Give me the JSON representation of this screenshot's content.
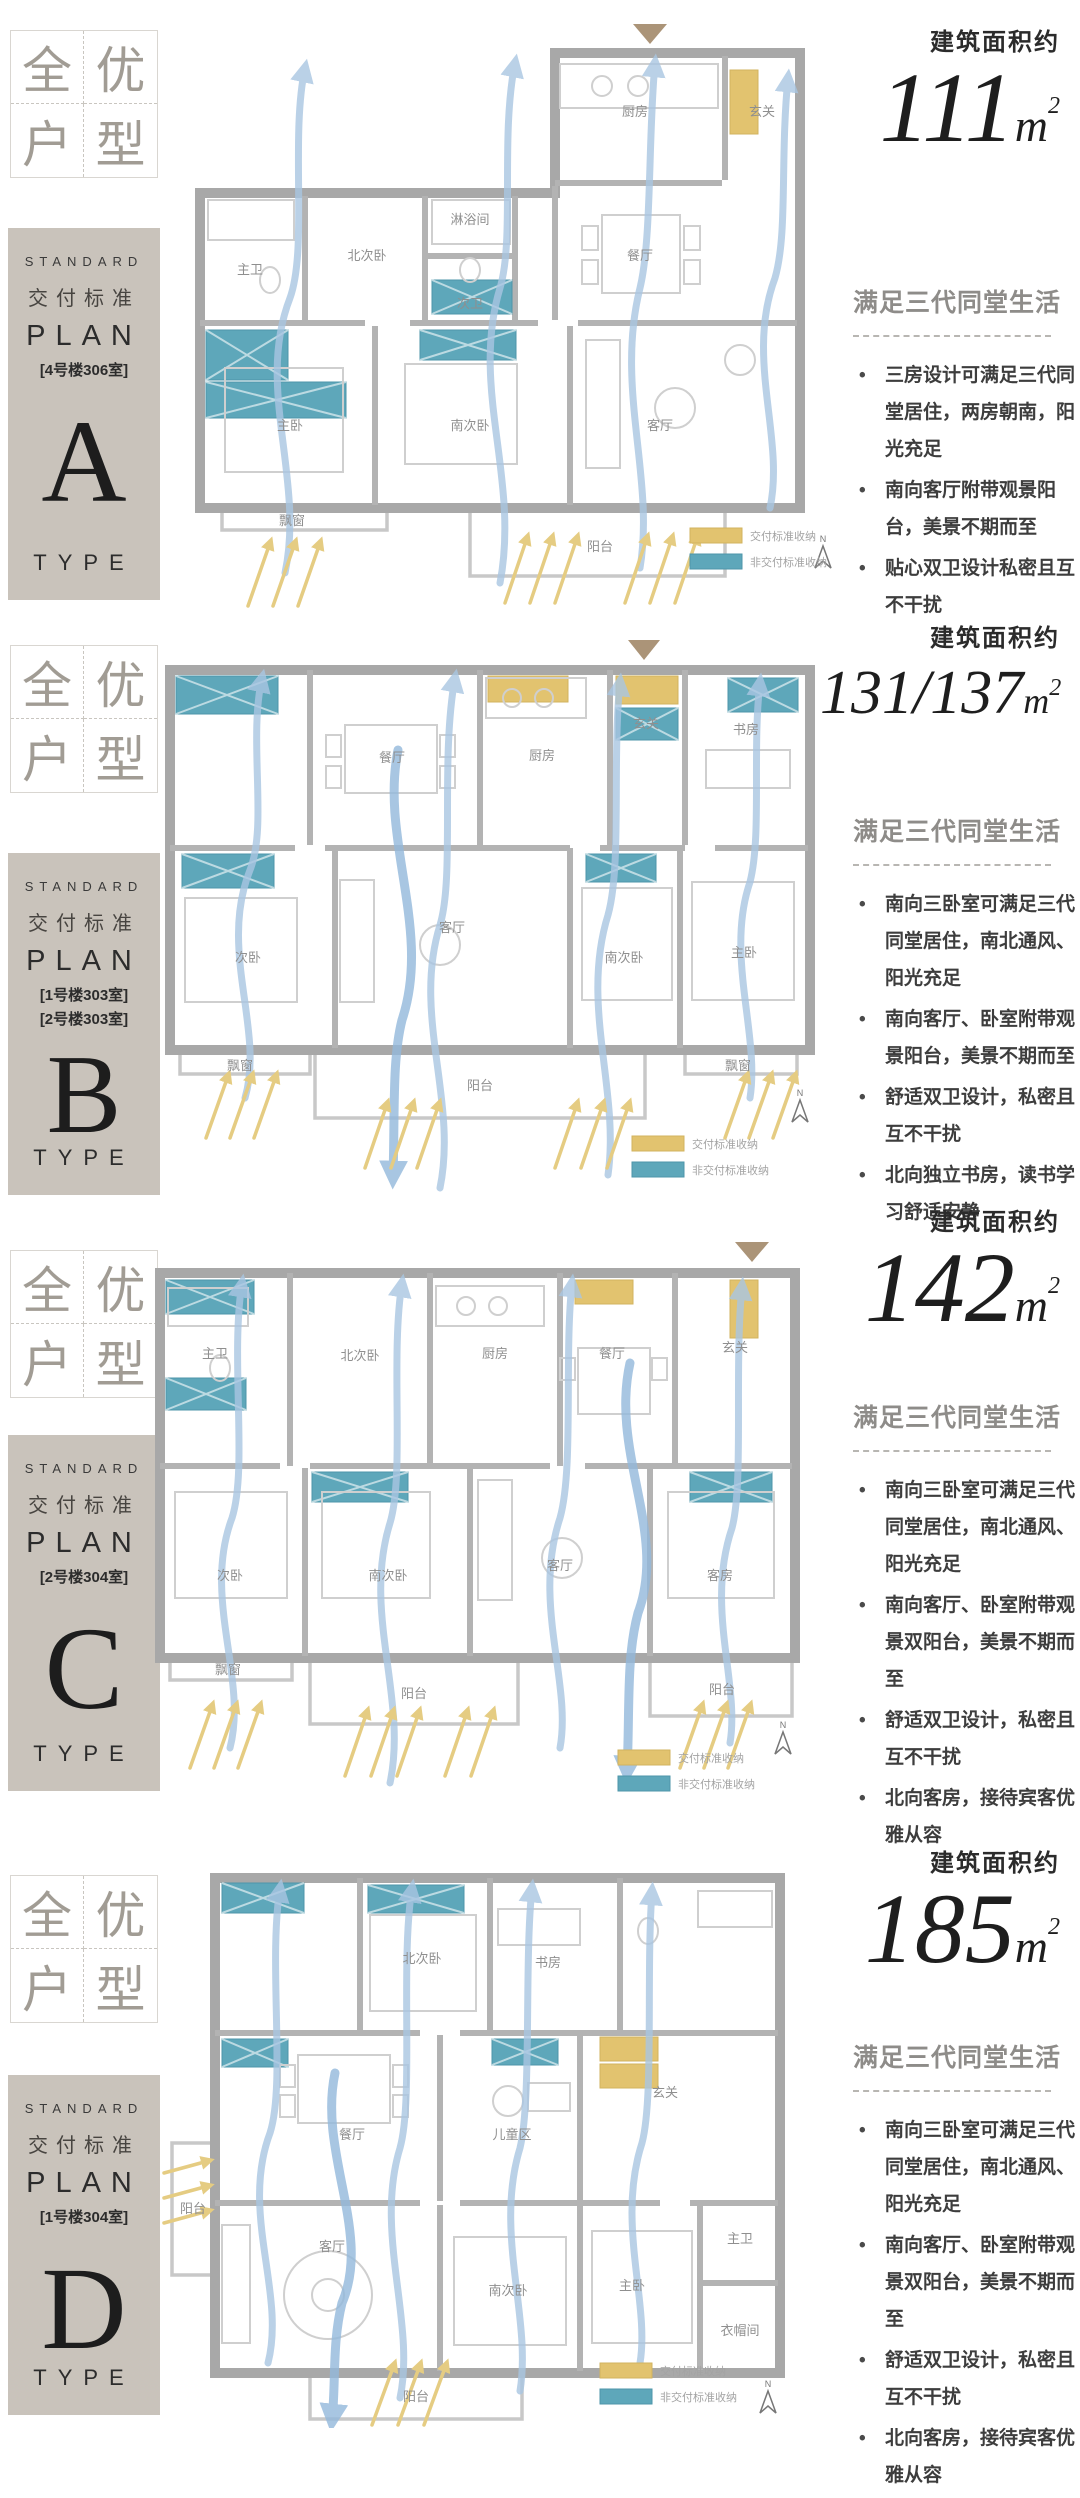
{
  "badge": {
    "c1": "全",
    "c2": "优",
    "c3": "户",
    "c4": "型"
  },
  "legend": {
    "standard": "交付标准收纳",
    "nonstandard": "非交付标准收纳"
  },
  "north": "N",
  "colors": {
    "plate_bg": "#c9c3bb",
    "storage_standard": "#e2c36f",
    "storage_nonstandard": "#5ea7ba",
    "airflow": "#a9c6e2",
    "sunlight": "#e5cc82"
  },
  "sections": [
    {
      "plate": {
        "en": "STANDARD",
        "cn": "交付标准",
        "plan": "PLAN",
        "units": [
          "[4号楼306室]"
        ],
        "letter": "A",
        "type": "TYPE"
      },
      "area": {
        "label": "建筑面积约",
        "value": "111",
        "unit_base": "m",
        "unit_sup": "2"
      },
      "desc": {
        "title": "满足三代同堂生活",
        "bullets": [
          "三房设计可满足三代同堂居住，两房朝南，阳光充足",
          "南向客厅附带观景阳台，美景不期而至",
          "贴心双卫设计私密且互不干扰"
        ]
      },
      "rooms": [
        "主卫",
        "北次卧",
        "淋浴间",
        "次卫",
        "厨房",
        "玄关",
        "餐厅",
        "主卧",
        "南次卧",
        "客厅",
        "阳台",
        "飘窗"
      ]
    },
    {
      "plate": {
        "en": "STANDARD",
        "cn": "交付标准",
        "plan": "PLAN",
        "units": [
          "[1号楼303室]",
          "[2号楼303室]"
        ],
        "letter": "B",
        "type": "TYPE"
      },
      "area": {
        "label": "建筑面积约",
        "value": "131/137",
        "unit_base": "m",
        "unit_sup": "2"
      },
      "desc": {
        "title": "满足三代同堂生活",
        "bullets": [
          "南向三卧室可满足三代同堂居住，南北通风、阳光充足",
          "南向客厅、卧室附带观景阳台，美景不期而至",
          "舒适双卫设计，私密且互不干扰",
          "北向独立书房，读书学习舒适安静"
        ]
      },
      "rooms": [
        "餐厅",
        "厨房",
        "玄关",
        "书房",
        "次卧",
        "客厅",
        "南次卧",
        "主卧",
        "阳台",
        "飘窗",
        "飘窗"
      ]
    },
    {
      "plate": {
        "en": "STANDARD",
        "cn": "交付标准",
        "plan": "PLAN",
        "units": [
          "[2号楼304室]"
        ],
        "letter": "C",
        "type": "TYPE"
      },
      "area": {
        "label": "建筑面积约",
        "value": "142",
        "unit_base": "m",
        "unit_sup": "2"
      },
      "desc": {
        "title": "满足三代同堂生活",
        "bullets": [
          "南向三卧室可满足三代同堂居住，南北通风、阳光充足",
          "南向客厅、卧室附带观景双阳台，美景不期而至",
          "舒适双卫设计，私密且互不干扰",
          "北向客房，接待宾客优雅从容"
        ]
      },
      "rooms": [
        "北次卧",
        "厨房",
        "餐厅",
        "玄关",
        "次卧",
        "南次卧",
        "客厅",
        "客房",
        "阳台",
        "阳台",
        "飘窗",
        "主卫"
      ]
    },
    {
      "plate": {
        "en": "STANDARD",
        "cn": "交付标准",
        "plan": "PLAN",
        "units": [
          "[1号楼304室]"
        ],
        "letter": "D",
        "type": "TYPE"
      },
      "area": {
        "label": "建筑面积约",
        "value": "185",
        "unit_base": "m",
        "unit_sup": "2"
      },
      "desc": {
        "title": "满足三代同堂生活",
        "bullets": [
          "南向三卧室可满足三代同堂居住，南北通风、阳光充足",
          "南向客厅、卧室附带观景双阳台，美景不期而至",
          "舒适双卫设计，私密且互不干扰",
          "北向客房，接待宾客优雅从容"
        ]
      },
      "rooms": [
        "北次卧",
        "书房",
        "餐厅",
        "儿童区",
        "玄关",
        "客厅",
        "南次卧",
        "主卧",
        "主卫",
        "衣帽间",
        "阳台",
        "阳台"
      ]
    }
  ]
}
